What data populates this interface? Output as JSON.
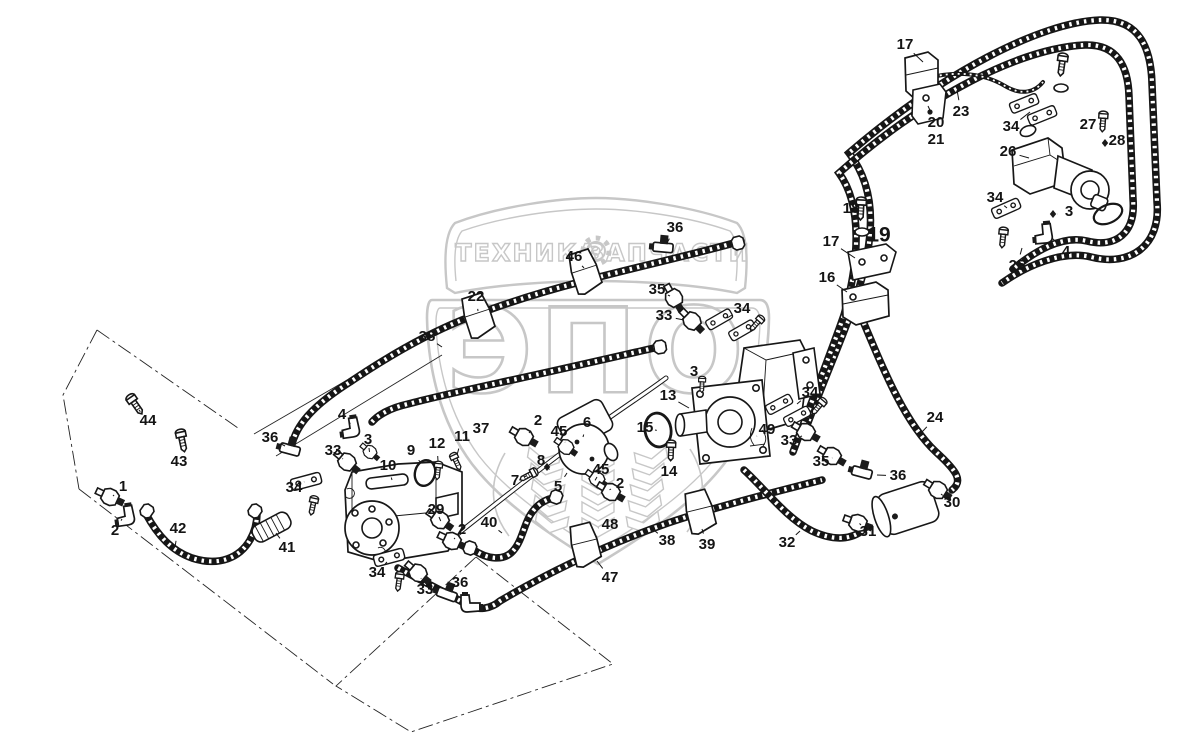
{
  "watermark": {
    "banner_left": "ТЕХНИКА",
    "banner_right": "ЗАПЧАСТИ",
    "shield_text": "ЭПО",
    "gear_icon": "gear-icon",
    "color": "#c7c7c7"
  },
  "diagram": {
    "type": "parts-diagram",
    "ink_color": "#171717",
    "labels": [
      {
        "n": "17",
        "x": 905,
        "y": 45,
        "tx": 923,
        "ty": 62
      },
      {
        "n": "23",
        "x": 961,
        "y": 112,
        "tx": 957,
        "ty": 90
      },
      {
        "n": "20",
        "x": 936,
        "y": 123,
        "tx": 928,
        "ty": 106
      },
      {
        "n": "21",
        "x": 936,
        "y": 140
      },
      {
        "n": "34",
        "x": 1011,
        "y": 127,
        "tx": 1030,
        "ty": 112
      },
      {
        "n": "27",
        "x": 1088,
        "y": 125,
        "tx": 1099,
        "ty": 124
      },
      {
        "n": "28",
        "x": 1117,
        "y": 141,
        "tx": 1107,
        "ty": 143
      },
      {
        "n": "26",
        "x": 1008,
        "y": 152,
        "tx": 1029,
        "ty": 158
      },
      {
        "n": "34",
        "x": 995,
        "y": 198,
        "tx": 1007,
        "ty": 208
      },
      {
        "n": "3",
        "x": 1069,
        "y": 212,
        "tx": 1057,
        "ty": 214
      },
      {
        "n": "4",
        "x": 1066,
        "y": 252,
        "tx": 1052,
        "ty": 238
      },
      {
        "n": "25",
        "x": 1017,
        "y": 266,
        "tx": 1022,
        "ty": 248
      },
      {
        "n": "18",
        "x": 851,
        "y": 209,
        "tx": 860,
        "ty": 219
      },
      {
        "n": "19",
        "x": 879,
        "y": 236,
        "size": "lg"
      },
      {
        "n": "17",
        "x": 831,
        "y": 242,
        "tx": 855,
        "ty": 258
      },
      {
        "n": "16",
        "x": 827,
        "y": 278,
        "tx": 847,
        "ty": 292
      },
      {
        "n": "36",
        "x": 675,
        "y": 228,
        "tx": 667,
        "ty": 243
      },
      {
        "n": "46",
        "x": 574,
        "y": 257,
        "tx": 584,
        "ty": 268
      },
      {
        "n": "35",
        "x": 657,
        "y": 290,
        "tx": 670,
        "ty": 296
      },
      {
        "n": "33",
        "x": 664,
        "y": 316,
        "tx": 684,
        "ty": 320
      },
      {
        "n": "34",
        "x": 742,
        "y": 309,
        "tx": 727,
        "ty": 318
      },
      {
        "n": "22",
        "x": 476,
        "y": 297,
        "tx": 478,
        "ty": 311
      },
      {
        "n": "38",
        "x": 427,
        "y": 337,
        "tx": 442,
        "ty": 347
      },
      {
        "n": "3",
        "x": 694,
        "y": 372,
        "tx": 701,
        "ty": 382
      },
      {
        "n": "13",
        "x": 668,
        "y": 396,
        "tx": 689,
        "ty": 408
      },
      {
        "n": "15",
        "x": 645,
        "y": 428,
        "tx": 655,
        "ty": 430
      },
      {
        "n": "14",
        "x": 669,
        "y": 472,
        "tx": 671,
        "ty": 459
      },
      {
        "n": "49",
        "x": 767,
        "y": 430,
        "tx": 757,
        "ty": 436
      },
      {
        "n": "34",
        "x": 810,
        "y": 393,
        "tx": 797,
        "ty": 404
      },
      {
        "n": "33",
        "x": 789,
        "y": 441,
        "tx": 802,
        "ty": 436
      },
      {
        "n": "35",
        "x": 821,
        "y": 462,
        "tx": 832,
        "ty": 458
      },
      {
        "n": "24",
        "x": 935,
        "y": 418,
        "tx": 922,
        "ty": 432
      },
      {
        "n": "36",
        "x": 898,
        "y": 476,
        "tx": 877,
        "ty": 475
      },
      {
        "n": "30",
        "x": 952,
        "y": 503,
        "tx": 941,
        "ty": 494
      },
      {
        "n": "31",
        "x": 868,
        "y": 532,
        "tx": 861,
        "ty": 525
      },
      {
        "n": "32",
        "x": 787,
        "y": 543,
        "tx": 800,
        "ty": 531
      },
      {
        "n": "44",
        "x": 148,
        "y": 421,
        "tx": 139,
        "ty": 410
      },
      {
        "n": "43",
        "x": 179,
        "y": 462,
        "tx": 182,
        "ty": 449
      },
      {
        "n": "1",
        "x": 123,
        "y": 487,
        "tx": 113,
        "ty": 496
      },
      {
        "n": "2",
        "x": 115,
        "y": 531,
        "tx": 122,
        "ty": 519
      },
      {
        "n": "42",
        "x": 178,
        "y": 529,
        "tx": 175,
        "ty": 547
      },
      {
        "n": "36",
        "x": 270,
        "y": 438,
        "tx": 285,
        "ty": 446
      },
      {
        "n": "33",
        "x": 333,
        "y": 451,
        "tx": 343,
        "ty": 459
      },
      {
        "n": "34",
        "x": 294,
        "y": 488,
        "tx": 304,
        "ty": 482
      },
      {
        "n": "41",
        "x": 287,
        "y": 548,
        "tx": 276,
        "ty": 533
      },
      {
        "n": "4",
        "x": 342,
        "y": 415,
        "tx": 350,
        "ty": 423
      },
      {
        "n": "3",
        "x": 368,
        "y": 440,
        "tx": 369,
        "ty": 448
      },
      {
        "n": "10",
        "x": 388,
        "y": 466,
        "tx": 392,
        "ty": 480
      },
      {
        "n": "9",
        "x": 411,
        "y": 451,
        "tx": 421,
        "ty": 463
      },
      {
        "n": "12",
        "x": 437,
        "y": 444,
        "tx": 438,
        "ty": 461
      },
      {
        "n": "11",
        "x": 462,
        "y": 437,
        "tx": 457,
        "ty": 455
      },
      {
        "n": "37",
        "x": 481,
        "y": 429
      },
      {
        "n": "29",
        "x": 436,
        "y": 510,
        "tx": 439,
        "ty": 517
      },
      {
        "n": "2",
        "x": 462,
        "y": 530,
        "tx": 455,
        "ty": 538
      },
      {
        "n": "40",
        "x": 489,
        "y": 523,
        "tx": 502,
        "ty": 533
      },
      {
        "n": "7",
        "x": 515,
        "y": 481,
        "tx": 524,
        "ty": 477
      },
      {
        "n": "8",
        "x": 541,
        "y": 461,
        "tx": 546,
        "ty": 466
      },
      {
        "n": "5",
        "x": 558,
        "y": 487,
        "tx": 567,
        "ty": 473
      },
      {
        "n": "6",
        "x": 587,
        "y": 423,
        "tx": 583,
        "ty": 437
      },
      {
        "n": "45",
        "x": 559,
        "y": 432,
        "tx": 565,
        "ty": 442
      },
      {
        "n": "45",
        "x": 601,
        "y": 470,
        "tx": 597,
        "ty": 477
      },
      {
        "n": "2",
        "x": 620,
        "y": 484,
        "tx": 611,
        "ty": 489
      },
      {
        "n": "48",
        "x": 610,
        "y": 525,
        "tx": 598,
        "ty": 528
      },
      {
        "n": "38",
        "x": 667,
        "y": 541,
        "tx": 655,
        "ty": 531
      },
      {
        "n": "39",
        "x": 707,
        "y": 545,
        "tx": 702,
        "ty": 529
      },
      {
        "n": "47",
        "x": 610,
        "y": 578,
        "tx": 597,
        "ty": 561
      },
      {
        "n": "34",
        "x": 377,
        "y": 573,
        "tx": 387,
        "ty": 562
      },
      {
        "n": "33",
        "x": 425,
        "y": 590,
        "tx": 421,
        "ty": 578
      },
      {
        "n": "36",
        "x": 460,
        "y": 583,
        "tx": 450,
        "ty": 591
      },
      {
        "n": "2",
        "x": 538,
        "y": 421,
        "tx": 529,
        "ty": 433
      }
    ]
  }
}
